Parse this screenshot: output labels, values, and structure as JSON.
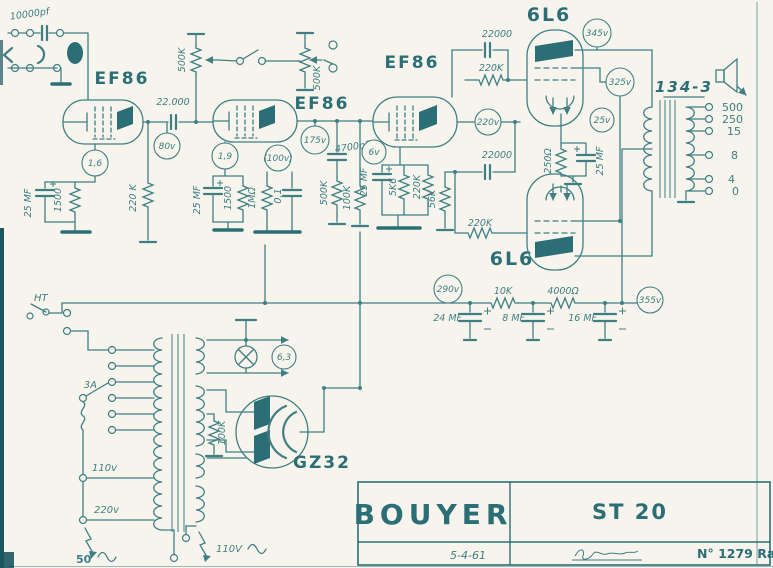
{
  "colors": {
    "ink": "#3f7f84",
    "ink_dark": "#2c6e76",
    "paper": "#f6f4ec"
  },
  "input": {
    "coupling_cap": "10000pf"
  },
  "v1": {
    "tube": "EF86",
    "cathode_v": "1,6",
    "plate_v": "80v",
    "cathode_cap": "25 MF",
    "cathode_res": "1500",
    "grid_leak": "220 K",
    "coupling_cap": "22.000",
    "volume_pot": "500K"
  },
  "v2": {
    "tube": "EF86",
    "cathode_v": "1,9",
    "screen_v": "(100v)",
    "plate_v": "175v",
    "cathode_cap": "25 MF",
    "cathode_res": "1500",
    "load_res": "1MΩ",
    "tone_cap": "0,1",
    "gain_pot": "500K",
    "coupling_cap": "4700pf"
  },
  "v3": {
    "tube": "EF86",
    "cathode_v": "6v",
    "plate_v": "220v",
    "tone_pot": "500K",
    "grid_res": "100K",
    "cathode_cap": "25 MF",
    "cathode_res": "5K6",
    "res_220k": "220K"
  },
  "driver": {
    "cap_top": "22000",
    "res_top": "220K",
    "cap_bottom": "22000",
    "res_bottom": "220K",
    "res_56k": "56K"
  },
  "power_stage": {
    "tube_top": "6L6",
    "tube_bottom": "6L6",
    "plate_v": "345v",
    "screen_v": "325v",
    "cathode_v": "25v",
    "cathode_res": "250Ω",
    "cathode_cap": "25 MF"
  },
  "output_transformer": {
    "model": "134-3",
    "taps": [
      "500",
      "250",
      "15",
      "8",
      "4",
      "0"
    ]
  },
  "b_rail": {
    "v_in": "290v",
    "res_10k": "10K",
    "res_4000": "4000Ω",
    "v_out": "355v",
    "cap_24": "24 MF",
    "cap_8": "8 MF",
    "cap_16": "16 MF"
  },
  "psu": {
    "ht": "HT",
    "fuse": "3A",
    "tap_110": "110v",
    "tap_220": "220v",
    "mains": "50",
    "pilot": "6,3",
    "rectifier": "GZ32",
    "bleeder": "100K",
    "aux": "110V"
  },
  "title_block": {
    "brand": "BOUYER",
    "model": "ST 20",
    "date": "5-4-61",
    "ref": "N° 1279 Ra"
  }
}
